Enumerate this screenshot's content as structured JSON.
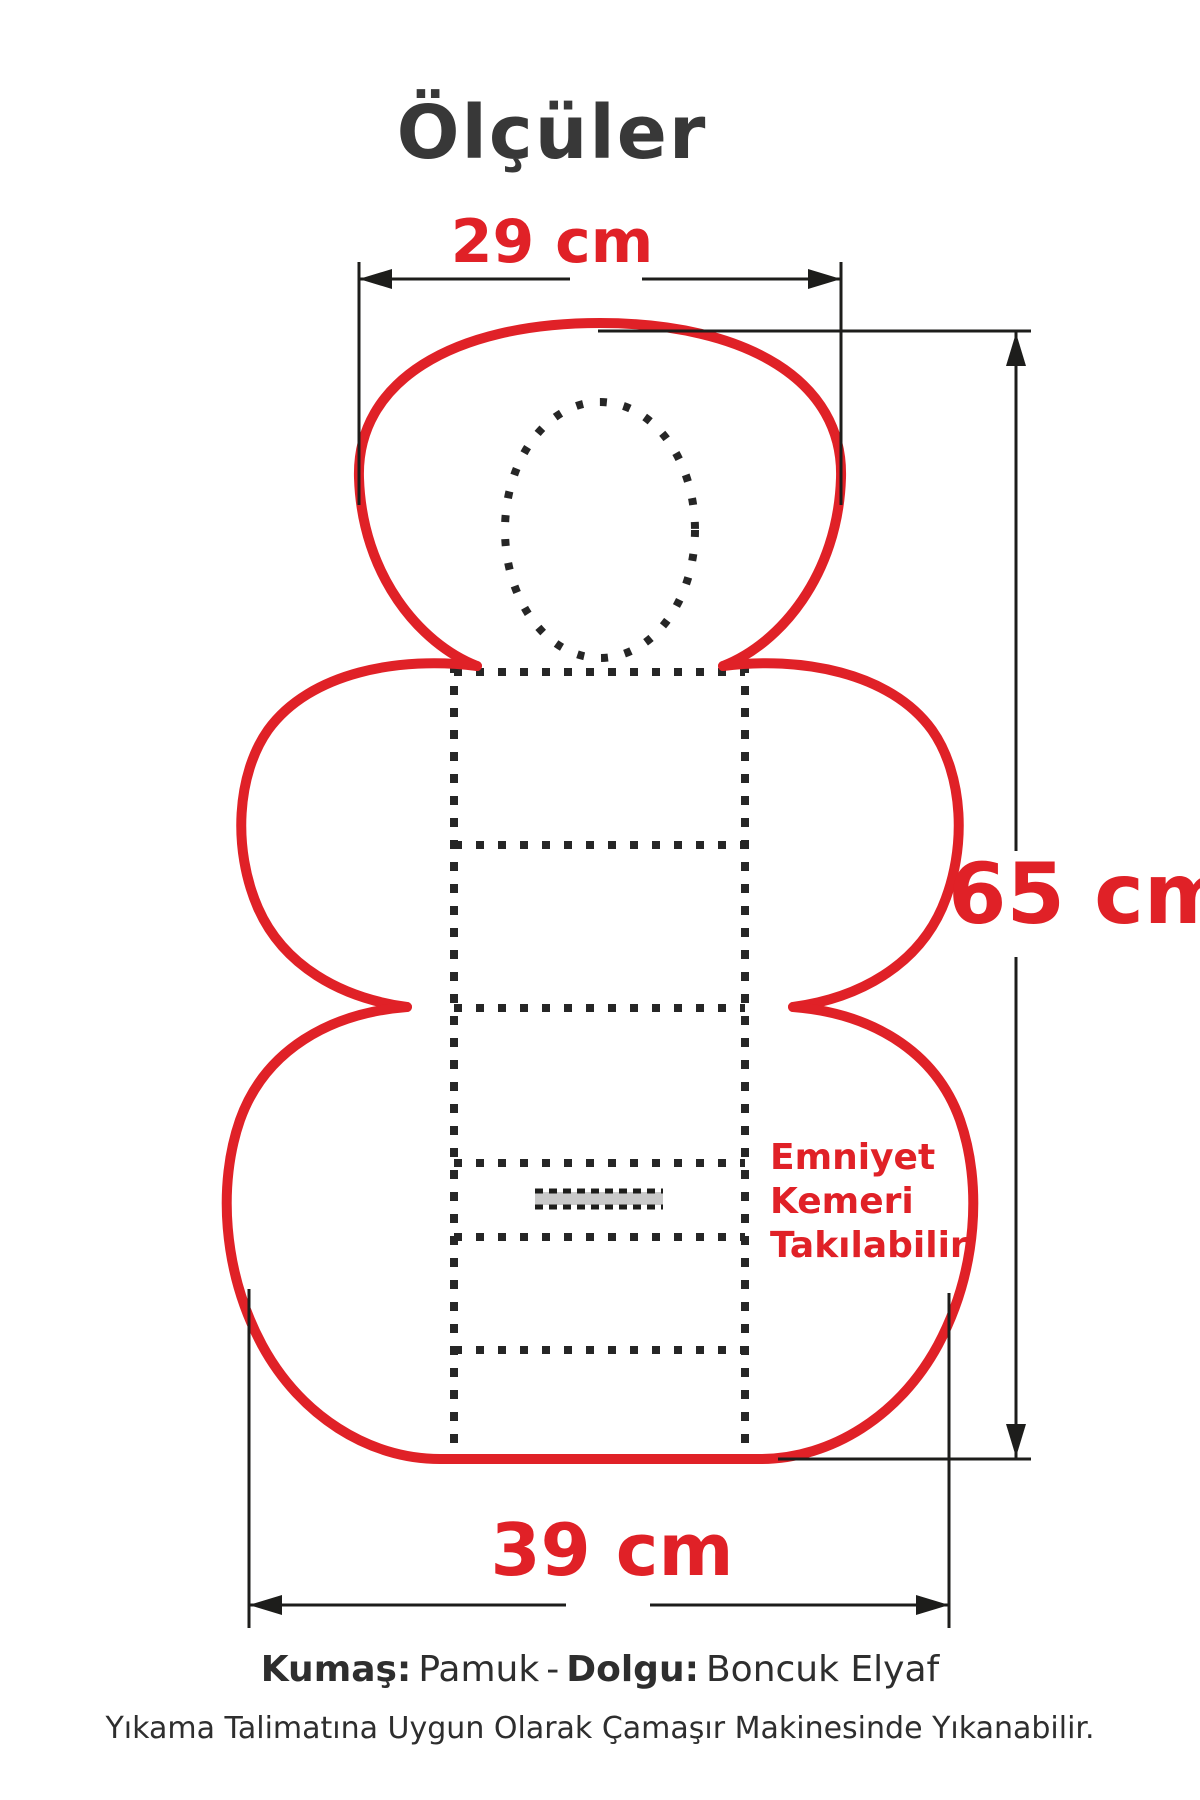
{
  "title": "Ölçüler",
  "dimensions": {
    "top_width": "29 cm",
    "height": "65 cm",
    "bottom_width": "39 cm"
  },
  "annotation": {
    "line1": "Emniyet",
    "line2": "Kemeri",
    "line3": "Takılabilir"
  },
  "footer": {
    "fabric_label": "Kumaş:",
    "fabric_value": "Pamuk",
    "separator": "-",
    "filling_label": "Dolgu:",
    "filling_value": "Boncuk Elyaf",
    "care_line": "Yıkama Talimatına Uygun Olarak Çamaşır Makinesinde Yıkanabilir."
  },
  "colors": {
    "accent_red": "#e02127",
    "line_black": "#1d1d1b",
    "dot_black": "#262626",
    "belt_gray": "#c9c9c9",
    "title_gray": "#383838"
  }
}
